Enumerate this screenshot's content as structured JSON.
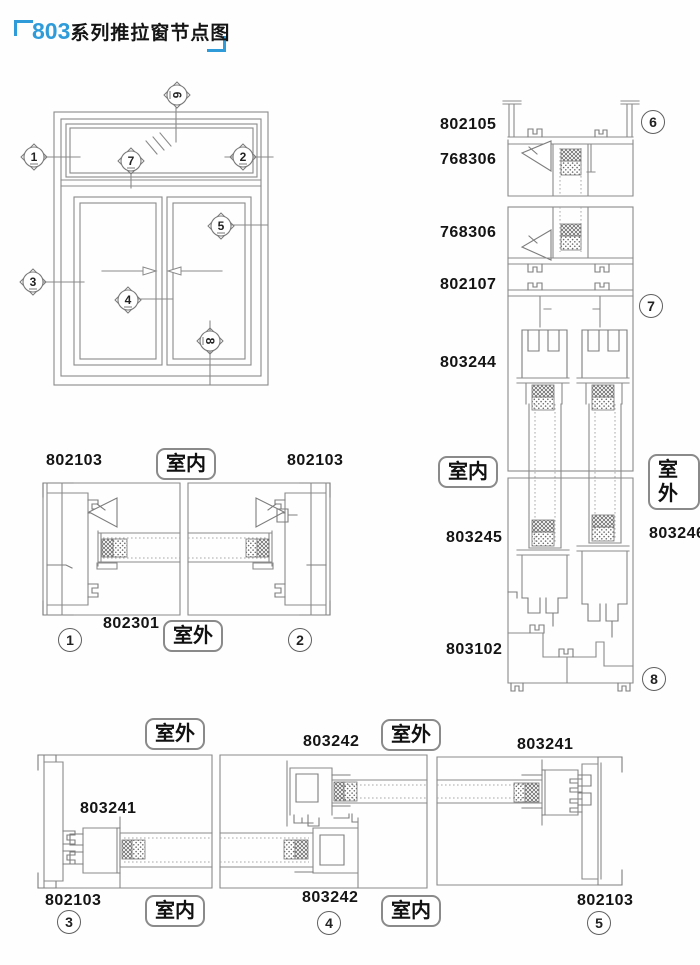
{
  "title": {
    "series": "803",
    "text": "系列推拉窗节点图"
  },
  "rooms": {
    "indoor": "室内",
    "outdoor": "室外"
  },
  "markers": {
    "m1": "1",
    "m2": "2",
    "m3": "3",
    "m4": "4",
    "m5": "5",
    "m6": "6",
    "m7": "7",
    "m8": "8"
  },
  "section_numbers": {
    "c1": "1",
    "c2": "2",
    "c3": "3",
    "c4": "4",
    "c5": "5",
    "c6": "6",
    "c7": "7",
    "c8": "8"
  },
  "parts": {
    "head_frame": "802105",
    "head_bead": "768306",
    "transom_bead": "768306",
    "transom": "802107",
    "sash_top": "803244",
    "sash_bottom_left": "803245",
    "sash_bottom_right": "803246",
    "sill": "803102",
    "jamb_left": "802103",
    "jamb_right": "802103",
    "fixed_mid": "802301",
    "slide_jamb_left": "802103",
    "slide_sash_left": "803241",
    "meet_top": "803242",
    "meet_bottom": "803242",
    "slide_sash_right": "803241",
    "slide_jamb_right": "802103"
  },
  "colors": {
    "accent_blue": "#2f9cd9",
    "line_gray": "#8a8a8a",
    "text": "#111111"
  }
}
